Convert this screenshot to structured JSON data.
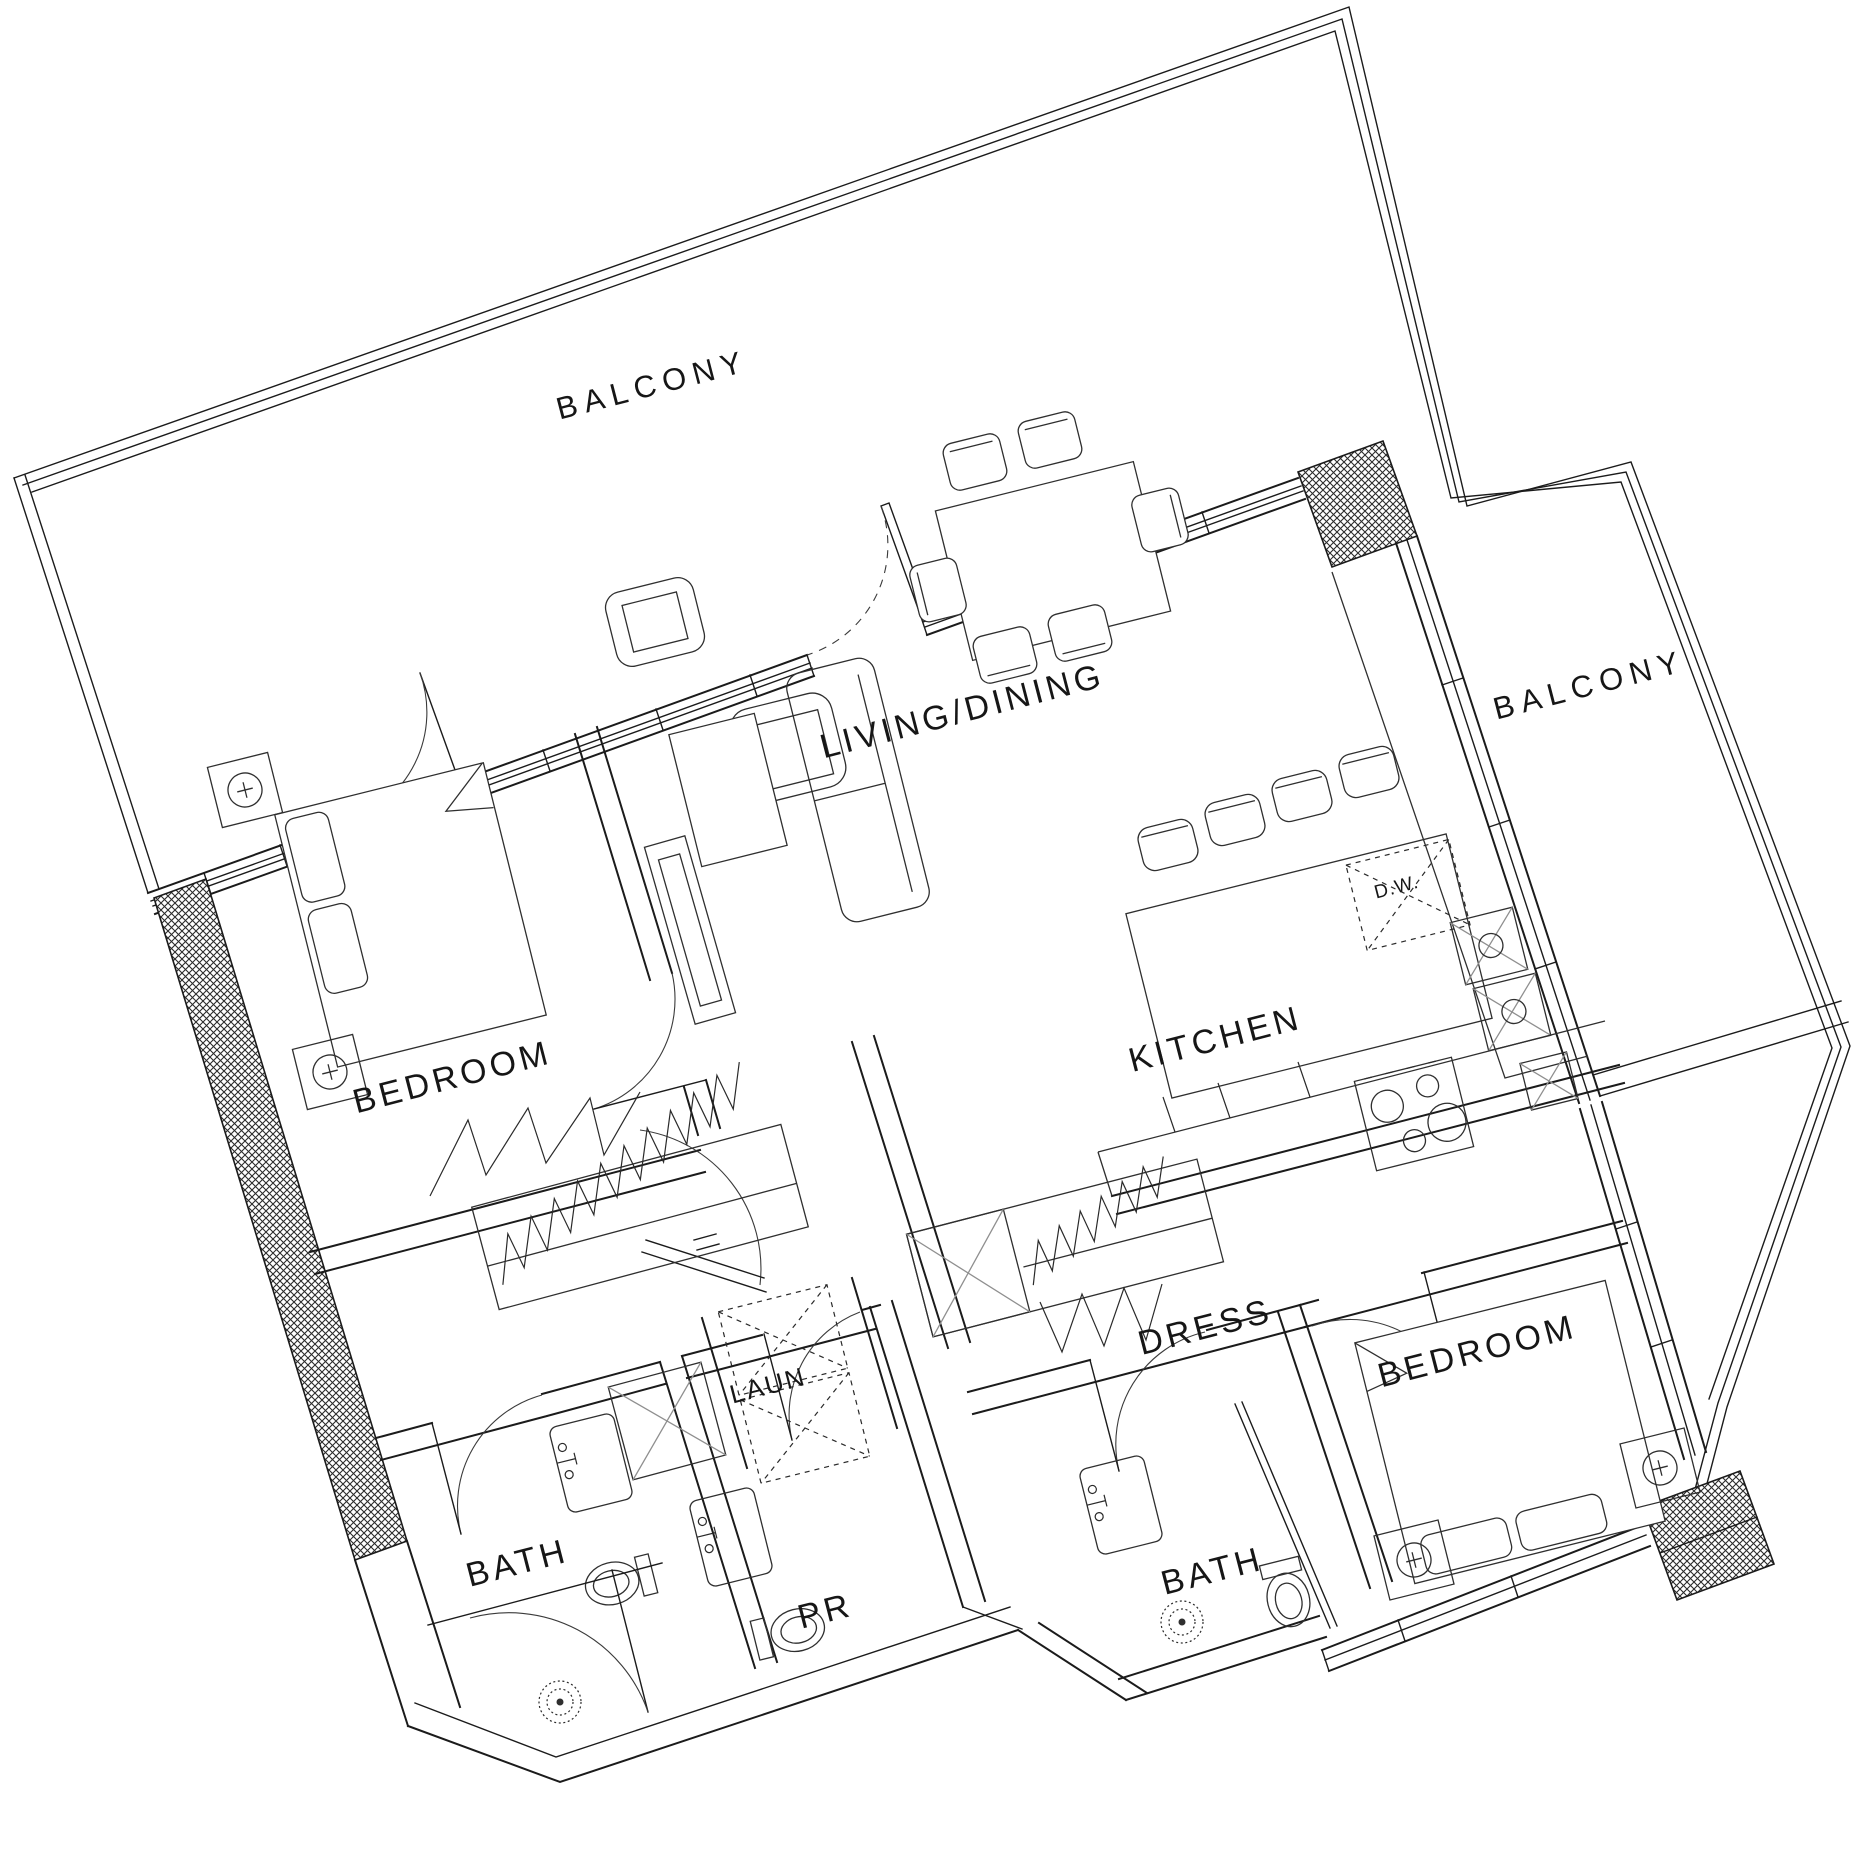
{
  "labels": {
    "balcony_top": "BALCONY",
    "balcony_right": "BALCONY",
    "living_dining": "LIVING/DINING",
    "kitchen": "KITCHEN",
    "bedroom_left": "BEDROOM",
    "bedroom_right": "BEDROOM",
    "dress": "DRESS",
    "laundry": "LAUN",
    "bath_left": "BATH",
    "bath_right": "BATH",
    "powder_room": "PR",
    "dishwasher": "D.W."
  },
  "colors": {
    "line": "#1b1b1b",
    "background": "#ffffff",
    "hatch": "#2b2b2b",
    "muted": "#8f8f8f"
  },
  "drawing": {
    "type": "apartment-floor-plan",
    "rotation_deg": -14.5
  }
}
